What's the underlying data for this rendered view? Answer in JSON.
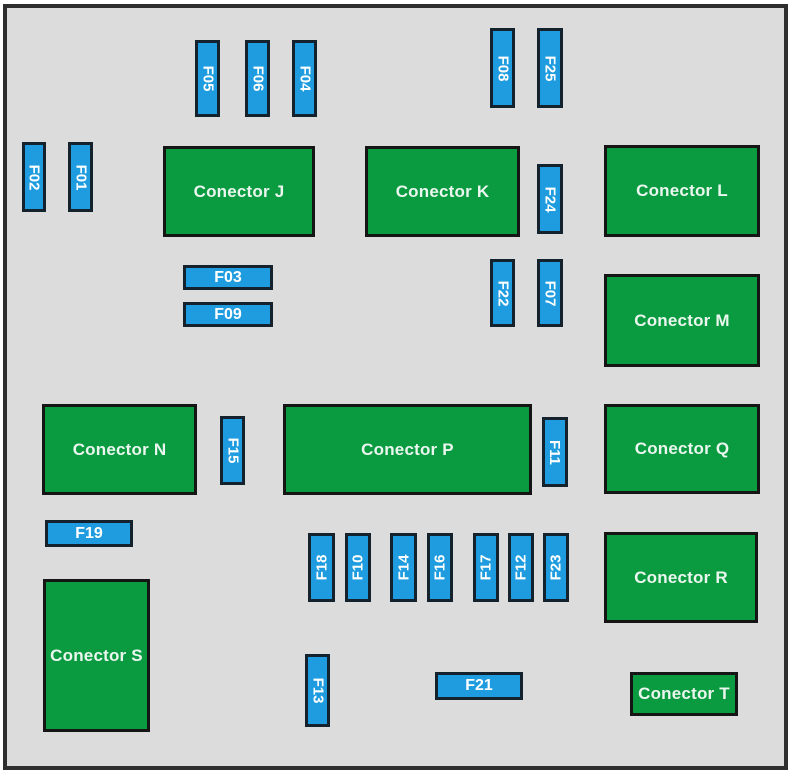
{
  "diagram": {
    "type": "fuse-box-diagram",
    "colors": {
      "panel_background": "#dcdcdc",
      "frame_border": "#2e2e2e",
      "connector_fill": "#0a9b41",
      "connector_border": "#151515",
      "connector_text": "#eaf6ee",
      "fuse_fill": "#1e9cdf",
      "fuse_border": "#14222e",
      "fuse_text": "#ffffff"
    },
    "frame": {
      "x": 3,
      "y": 4,
      "w": 785,
      "h": 766
    },
    "connectors": [
      {
        "label": "Conector J",
        "x": 163,
        "y": 146,
        "w": 152,
        "h": 91
      },
      {
        "label": "Conector K",
        "x": 365,
        "y": 146,
        "w": 155,
        "h": 91
      },
      {
        "label": "Conector L",
        "x": 604,
        "y": 145,
        "w": 156,
        "h": 92
      },
      {
        "label": "Conector M",
        "x": 604,
        "y": 274,
        "w": 156,
        "h": 93
      },
      {
        "label": "Conector N",
        "x": 42,
        "y": 404,
        "w": 155,
        "h": 91
      },
      {
        "label": "Conector P",
        "x": 283,
        "y": 404,
        "w": 249,
        "h": 91
      },
      {
        "label": "Conector Q",
        "x": 604,
        "y": 404,
        "w": 156,
        "h": 90
      },
      {
        "label": "Conector R",
        "x": 604,
        "y": 532,
        "w": 154,
        "h": 91
      },
      {
        "label": "Conector S",
        "x": 43,
        "y": 579,
        "w": 107,
        "h": 153
      },
      {
        "label": "Conector T",
        "x": 630,
        "y": 672,
        "w": 108,
        "h": 44
      }
    ],
    "fuses": [
      {
        "label": "F05",
        "x": 195,
        "y": 40,
        "w": 25,
        "h": 77,
        "orientation": "down"
      },
      {
        "label": "F06",
        "x": 245,
        "y": 40,
        "w": 25,
        "h": 77,
        "orientation": "down"
      },
      {
        "label": "F04",
        "x": 292,
        "y": 40,
        "w": 25,
        "h": 77,
        "orientation": "down"
      },
      {
        "label": "F08",
        "x": 490,
        "y": 28,
        "w": 25,
        "h": 80,
        "orientation": "down"
      },
      {
        "label": "F25",
        "x": 537,
        "y": 28,
        "w": 26,
        "h": 80,
        "orientation": "down"
      },
      {
        "label": "F02",
        "x": 22,
        "y": 142,
        "w": 24,
        "h": 70,
        "orientation": "down"
      },
      {
        "label": "F01",
        "x": 68,
        "y": 142,
        "w": 25,
        "h": 70,
        "orientation": "down"
      },
      {
        "label": "F24",
        "x": 537,
        "y": 164,
        "w": 26,
        "h": 70,
        "orientation": "down"
      },
      {
        "label": "F03",
        "x": 183,
        "y": 265,
        "w": 90,
        "h": 25,
        "orientation": "horizontal"
      },
      {
        "label": "F09",
        "x": 183,
        "y": 302,
        "w": 90,
        "h": 25,
        "orientation": "horizontal"
      },
      {
        "label": "F22",
        "x": 490,
        "y": 259,
        "w": 25,
        "h": 68,
        "orientation": "down"
      },
      {
        "label": "F07",
        "x": 537,
        "y": 259,
        "w": 26,
        "h": 68,
        "orientation": "down"
      },
      {
        "label": "F15",
        "x": 220,
        "y": 416,
        "w": 25,
        "h": 69,
        "orientation": "down"
      },
      {
        "label": "F11",
        "x": 542,
        "y": 417,
        "w": 26,
        "h": 70,
        "orientation": "down"
      },
      {
        "label": "F19",
        "x": 45,
        "y": 520,
        "w": 88,
        "h": 27,
        "orientation": "horizontal"
      },
      {
        "label": "F18",
        "x": 308,
        "y": 533,
        "w": 27,
        "h": 69,
        "orientation": "up"
      },
      {
        "label": "F10",
        "x": 345,
        "y": 533,
        "w": 26,
        "h": 69,
        "orientation": "up"
      },
      {
        "label": "F14",
        "x": 390,
        "y": 533,
        "w": 27,
        "h": 69,
        "orientation": "up"
      },
      {
        "label": "F16",
        "x": 427,
        "y": 533,
        "w": 26,
        "h": 69,
        "orientation": "up"
      },
      {
        "label": "F17",
        "x": 473,
        "y": 533,
        "w": 26,
        "h": 69,
        "orientation": "up"
      },
      {
        "label": "F12",
        "x": 508,
        "y": 533,
        "w": 26,
        "h": 69,
        "orientation": "up"
      },
      {
        "label": "F23",
        "x": 543,
        "y": 533,
        "w": 26,
        "h": 69,
        "orientation": "up"
      },
      {
        "label": "F13",
        "x": 305,
        "y": 654,
        "w": 25,
        "h": 73,
        "orientation": "down"
      },
      {
        "label": "F21",
        "x": 435,
        "y": 672,
        "w": 88,
        "h": 28,
        "orientation": "horizontal"
      }
    ]
  }
}
